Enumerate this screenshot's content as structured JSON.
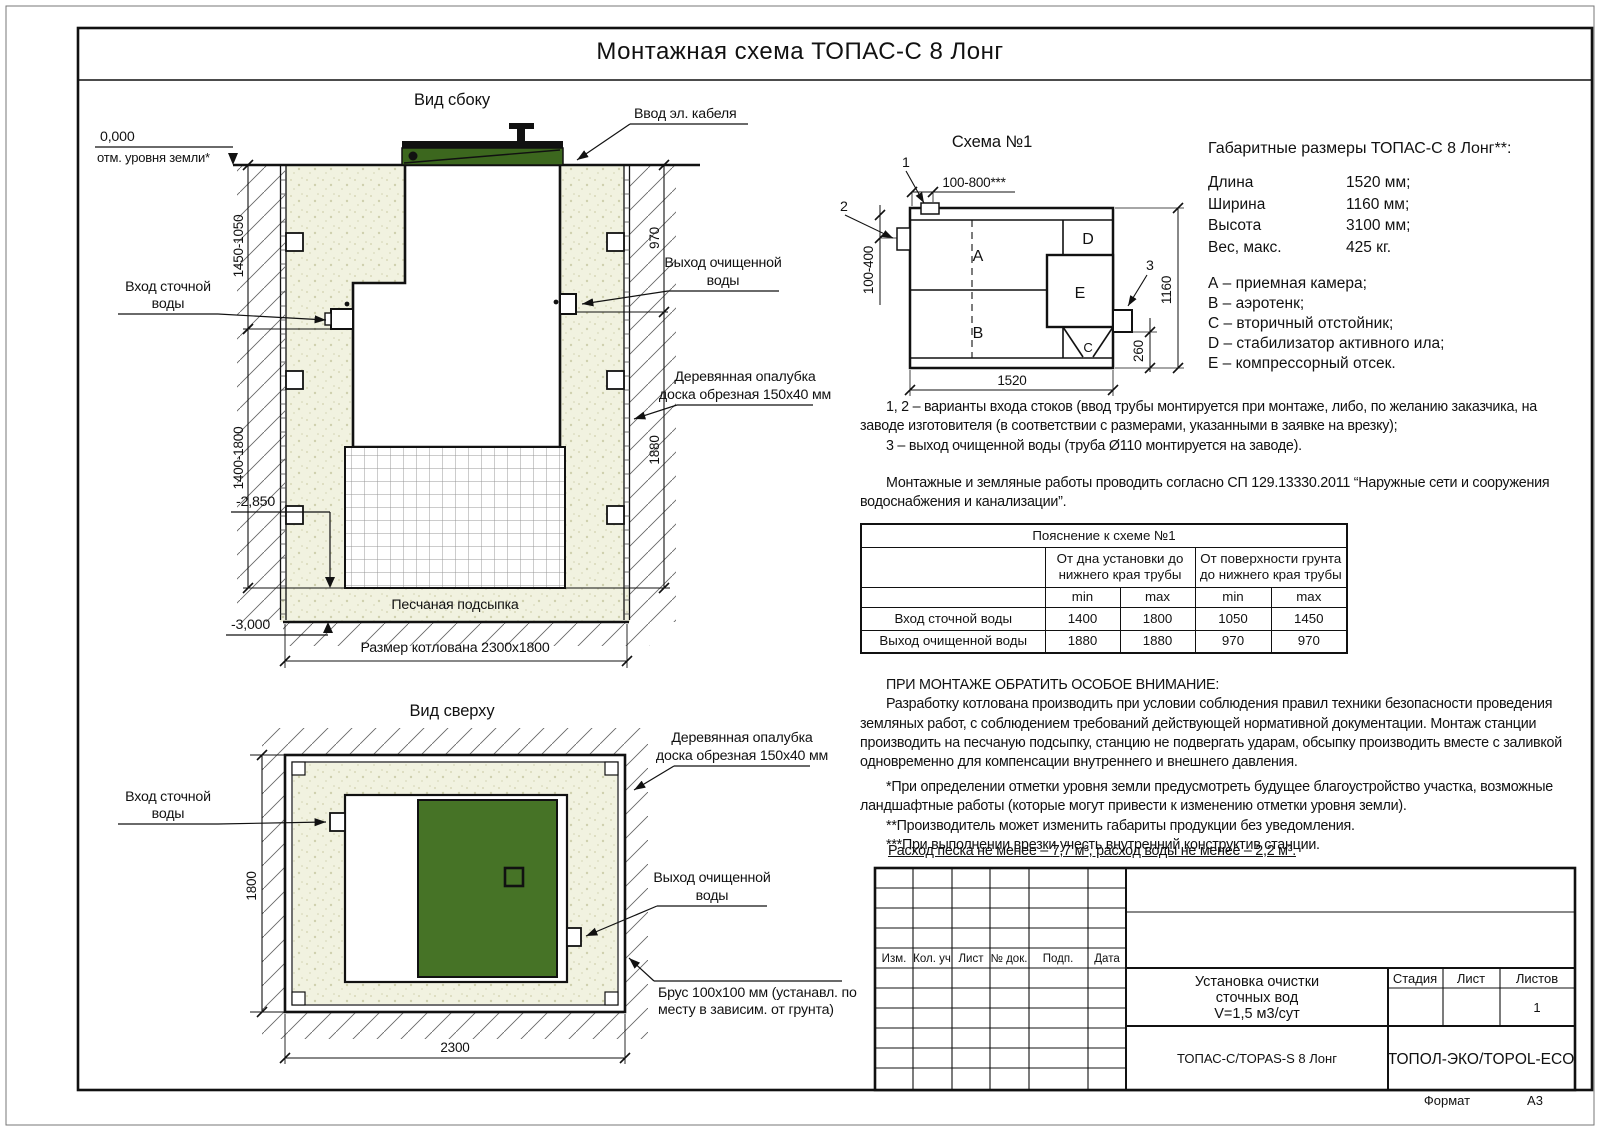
{
  "page": {
    "title": "Монтажная схема ТОПАС-С 8 Лонг",
    "format_label": "Формат",
    "format_value": "А3"
  },
  "colors": {
    "green_lid": "#3c671e",
    "green_top": "#467326",
    "sand": "#f1f2e0",
    "line": "#111111"
  },
  "side_view": {
    "title": "Вид сбоку",
    "labels": {
      "cable": "Ввод эл. кабеля",
      "inlet_1": "Вход сточной",
      "inlet_2": "воды",
      "outlet_1": "Выход очищенной",
      "outlet_2": "воды",
      "formwork_1": "Деревянная опалубка",
      "formwork_2": "доска обрезная 150x40 мм",
      "sand_bed": "Песчаная подсыпка",
      "pit_size": "Размер котлована 2300x1800"
    },
    "levels": {
      "zero": "0,000",
      "zero_sub": "отм. уровня земли*",
      "minus2850": "-2,850",
      "minus3000": "-3,000"
    },
    "dims": {
      "upper_left": "1450-1050",
      "lower_left": "1400-1800",
      "upper_right": "970",
      "lower_right": "1880"
    }
  },
  "top_view": {
    "title": "Вид сверху",
    "labels": {
      "inlet_1": "Вход сточной",
      "inlet_2": "воды",
      "formwork_1": "Деревянная опалубка",
      "formwork_2": "доска обрезная 150x40 мм",
      "outlet_1": "Выход очищенной",
      "outlet_2": "воды",
      "beam_1": "Брус 100x100 мм (устанавл. по",
      "beam_2": "месту в зависим. от грунта)"
    },
    "dims": {
      "width": "2300",
      "height": "1800"
    }
  },
  "schema": {
    "title": "Схема №1",
    "compartments": {
      "a": "A",
      "b": "B",
      "c": "C",
      "d": "D",
      "e": "E"
    },
    "callouts": {
      "c1": "1",
      "c2": "2",
      "c3": "3"
    },
    "dims": {
      "top": "100-800***",
      "left": "100-400",
      "right": "1160",
      "right_small": "260",
      "bottom": "1520"
    }
  },
  "specs": {
    "title": "Габаритные размеры ТОПАС-С 8 Лонг**:",
    "rows": [
      {
        "label": "Длина",
        "value": "1520 мм;"
      },
      {
        "label": "Ширина",
        "value": "1160 мм;"
      },
      {
        "label": "Высота",
        "value": "3100 мм;"
      },
      {
        "label": "Вес, макс.",
        "value": "425 кг."
      }
    ],
    "legend": [
      "А – приемная камера;",
      "В – аэротенк;",
      "С – вторичный отстойник;",
      "D – стабилизатор активного ила;",
      "Е – компрессорный отсек."
    ]
  },
  "notes": {
    "para1": [
      "1, 2 – варианты входа  стоков (ввод трубы монтируется при монтаже, либо, по желанию заказчика, на",
      "заводе изготовителя (в соответствии с размерами, указанными в заявке на врезку);",
      "3 – выход очищенной воды (труба Ø110 монтируется на заводе)."
    ],
    "para2": [
      "Монтажные и земляные работы проводить согласно СП 129.13330.2011 “Наружные сети и сооружения",
      "водоснабжения и канализации”."
    ],
    "attention": [
      "ПРИ МОНТАЖЕ ОБРАТИТЬ ОСОБОЕ ВНИМАНИЕ:",
      "Разработку котлована производить при условии соблюдения правил техники безопасности проведения",
      "земляных работ, с соблюдением требований действующей нормативной документации. Монтаж станции",
      "производить на песчаную подсыпку, станцию не подвергать ударам, обсыпку производить вместе с заливкой",
      "одновременно для компенсации внутреннего и внешнего давления."
    ],
    "footnotes": [
      "*При определении отметки уровня земли предусмотреть будущее благоустройство участка, возможные",
      "ландшафтные работы (которые могут привести к изменению отметки уровня земли).",
      "**Производитель может изменить габариты продукции без уведомления.",
      "***При выполнении врезки учесть внутренний конструктив станции."
    ],
    "consumption": "Расход песка не менее – 7,7 м³, расход воды не менее – 2,2 м³."
  },
  "table": {
    "title": "Пояснение к схеме №1",
    "group1": "От дна установки до нижнего края трубы",
    "group2": "От поверхности грунта до нижнего края трубы",
    "min1": "min",
    "max1": "max",
    "min2": "min",
    "max2": "max",
    "rows": [
      {
        "label": "Вход сточной воды",
        "v": [
          "1400",
          "1800",
          "1050",
          "1450"
        ]
      },
      {
        "label": "Выход очищенной воды",
        "v": [
          "1880",
          "1880",
          "970",
          "970"
        ]
      }
    ]
  },
  "stamp": {
    "cols": [
      "Изм.",
      "Кол. уч",
      "Лист",
      "№ док.",
      "Подп.",
      "Дата"
    ],
    "project": [
      "Установка очистки",
      "сточных вод",
      "V=1,5 м3/сут"
    ],
    "stage": "Стадия",
    "sheet": "Лист",
    "sheets": "Листов",
    "sheets_value": "1",
    "model": "ТОПАС-С/TOPAS-S 8 Лонг",
    "company": "ТОПОЛ-ЭКО/TOPOL-ECO"
  }
}
